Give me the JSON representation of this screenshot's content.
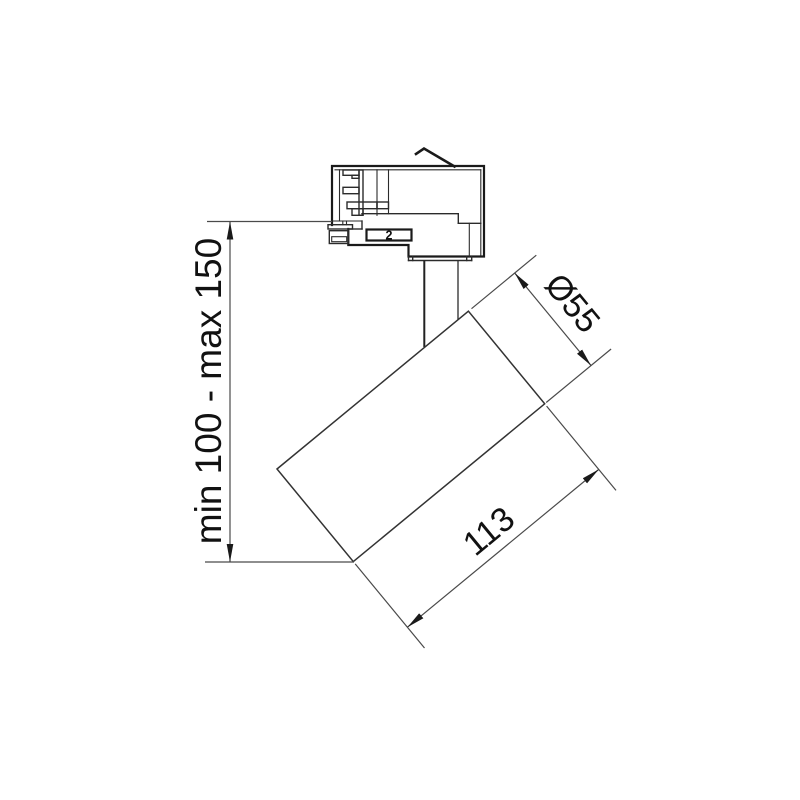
{
  "drawing": {
    "background": "#ffffff",
    "line_color": "#1a1a1a",
    "dimension_line_color": "#4a4a4a",
    "text_color": "#111111"
  },
  "dimensions": {
    "height": {
      "label": "min 100 - max 150"
    },
    "diameter": {
      "label": "Ø55"
    },
    "length": {
      "label": "113"
    }
  },
  "adapter": {
    "marking": "2"
  }
}
